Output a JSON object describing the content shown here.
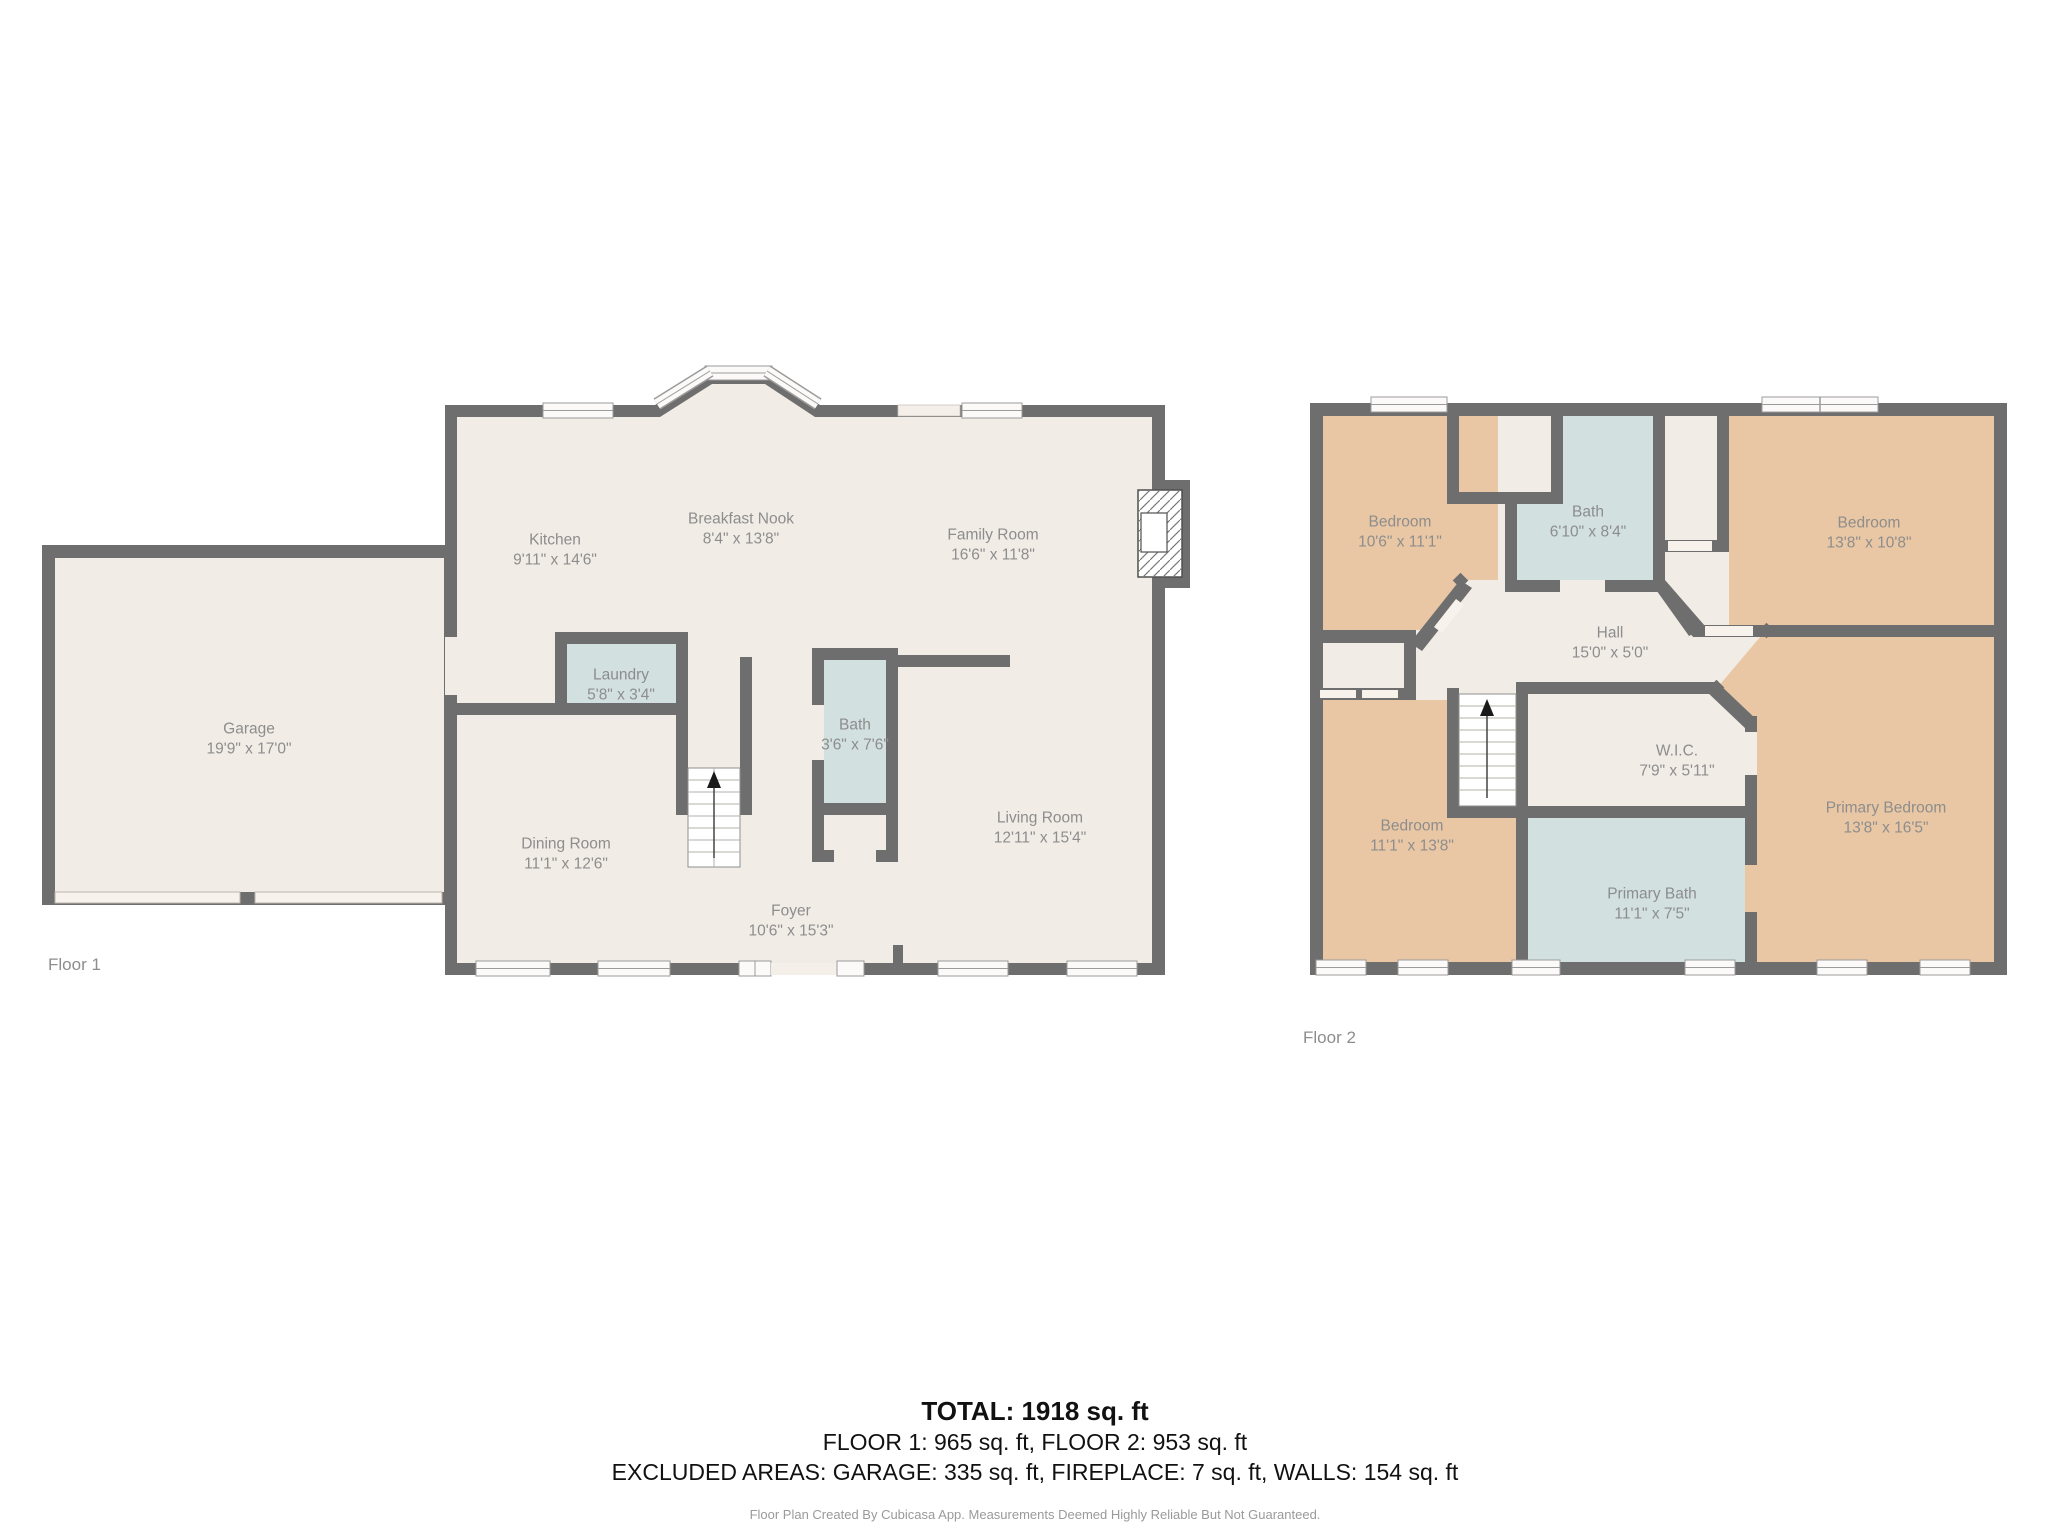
{
  "floor1": {
    "caption": "Floor 1",
    "rooms": {
      "kitchen": {
        "name": "Kitchen",
        "dims": "9'11\" x 14'6\""
      },
      "breakfast_nook": {
        "name": "Breakfast Nook",
        "dims": "8'4\" x 13'8\""
      },
      "family_room": {
        "name": "Family Room",
        "dims": "16'6\" x 11'8\""
      },
      "garage": {
        "name": "Garage",
        "dims": "19'9\" x 17'0\""
      },
      "laundry": {
        "name": "Laundry",
        "dims": "5'8\" x 3'4\""
      },
      "bath": {
        "name": "Bath",
        "dims": "3'6\" x 7'6\""
      },
      "dining_room": {
        "name": "Dining Room",
        "dims": "11'1\" x 12'6\""
      },
      "living_room": {
        "name": "Living Room",
        "dims": "12'11\" x 15'4\""
      },
      "foyer": {
        "name": "Foyer",
        "dims": "10'6\" x 15'3\""
      }
    }
  },
  "floor2": {
    "caption": "Floor 2",
    "rooms": {
      "bedroom_nw": {
        "name": "Bedroom",
        "dims": "10'6\" x 11'1\""
      },
      "bath": {
        "name": "Bath",
        "dims": "6'10\" x 8'4\""
      },
      "bedroom_ne": {
        "name": "Bedroom",
        "dims": "13'8\" x 10'8\""
      },
      "hall": {
        "name": "Hall",
        "dims": "15'0\" x 5'0\""
      },
      "wic": {
        "name": "W.I.C.",
        "dims": "7'9\" x 5'11\""
      },
      "bedroom_sw": {
        "name": "Bedroom",
        "dims": "11'1\" x 13'8\""
      },
      "primary_bath": {
        "name": "Primary Bath",
        "dims": "11'1\" x 7'5\""
      },
      "primary_bedroom": {
        "name": "Primary Bedroom",
        "dims": "13'8\" x 16'5\""
      }
    }
  },
  "summary": {
    "total": "TOTAL: 1918 sq. ft",
    "floors": "FLOOR 1: 965 sq. ft, FLOOR 2: 953 sq. ft",
    "excluded": "EXCLUDED AREAS: GARAGE: 335 sq. ft, FIREPLACE: 7 sq. ft, WALLS: 154 sq. ft",
    "disclaimer": "Floor Plan Created By Cubicasa App. Measurements Deemed Highly Reliable But Not Guaranteed."
  },
  "colors": {
    "wall": "#6e6e6e",
    "floor": "#f2ece6",
    "bedroom": "#eac7a4",
    "wet_room": "#d2e0e0",
    "label_text": "#8d8d8d"
  }
}
